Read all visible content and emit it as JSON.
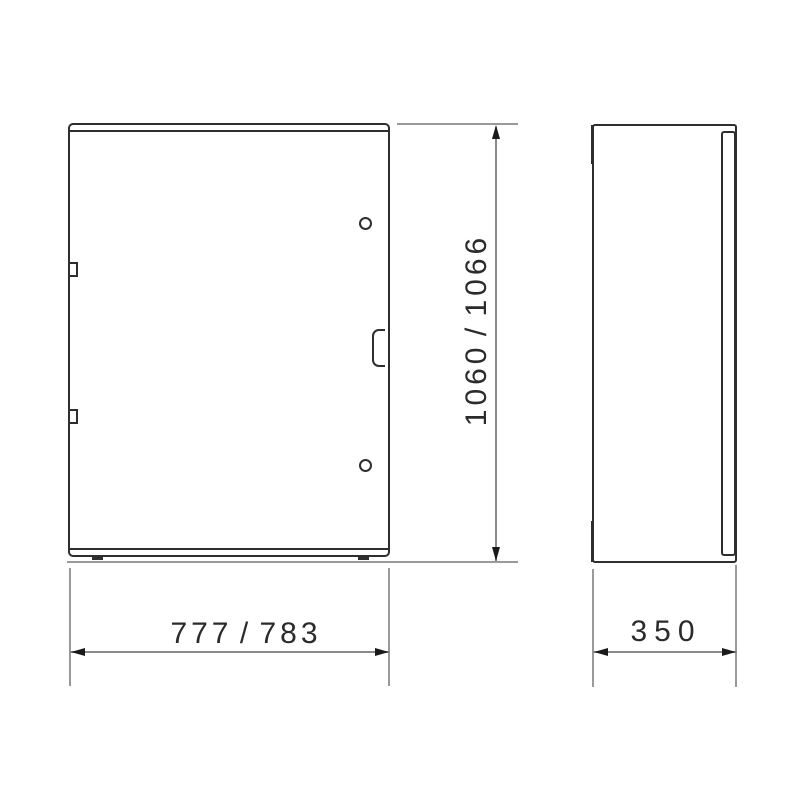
{
  "drawing": {
    "type": "technical-drawing",
    "subject": "enclosure-cabinet-two-views",
    "colors": {
      "outline": "#2e2e2e",
      "dimension_line": "#8a8a8a",
      "extension_line": "#9a9a9a",
      "text": "#2b2b2b",
      "background": "#ffffff"
    },
    "dimensions": {
      "height": {
        "label": "1060 / 1066"
      },
      "width": {
        "label": "777 / 783"
      },
      "depth": {
        "label": "350"
      }
    }
  }
}
